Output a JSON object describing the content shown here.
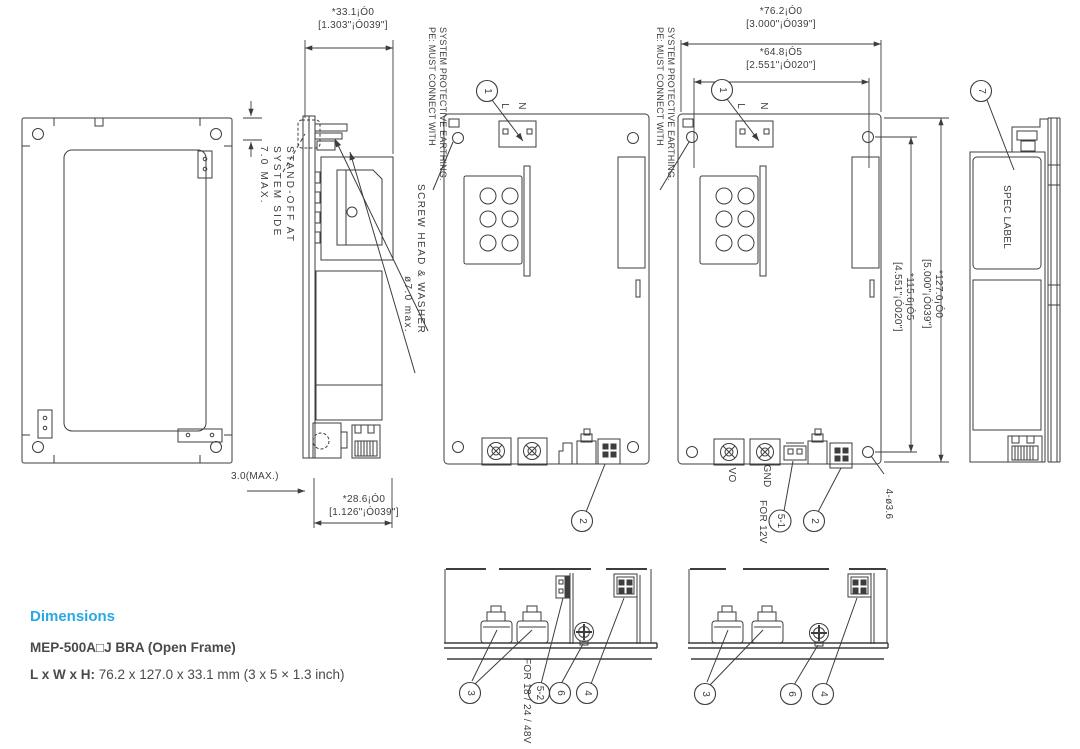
{
  "colors": {
    "accent": "#29a9e1",
    "line": "#3d3d3d",
    "text": "#4a4a4a"
  },
  "dims": {
    "w33_mm": "*33.1¡Ó0",
    "w33_in": "[1.303\"¡Ó039\"]",
    "w76_mm": "*76.2¡Ó0",
    "w76_in": "[3.000\"¡Ó039\"]",
    "w64_mm": "*64.8¡Ó5",
    "w64_in": "[2.551\"¡Ó020\"]",
    "h127_mm": "*127.0¡Ó0",
    "h127_in": "[5.000\"¡Ó039\"]",
    "h115_mm": "*115.6¡Ó5",
    "h115_in": "[4.551\"¡Ó020\"]",
    "w28_mm": "*28.6¡Ó0",
    "w28_in": "[1.126\"¡Ó039\"]",
    "t3_max": "3.0(MAX.)",
    "standoff_1": "STAND-OFF AT",
    "standoff_2": "SYSTEM SIDE",
    "standoff_3": "7.0 MAX.",
    "mounting_holes": "4-ø3.6"
  },
  "notes": {
    "pe_1": "PE: MUST CONNECT WITH",
    "pe_2": "SYSTEM PROTECTIVE EARTHING.",
    "screw_1": "SCREW HEAD & WASHER",
    "screw_2": "ø7.0 max.",
    "spec_label": "SPEC LABEL",
    "for_12v": "FOR 12V",
    "for_18_24_48v": "FOR 18 / 24 / 48V"
  },
  "labels": {
    "l": "L",
    "n": "N",
    "vo": "VO",
    "gnd": "GND"
  },
  "callouts": {
    "c1": "1",
    "c2": "2",
    "c3": "3",
    "c4": "4",
    "c5_1": "5-1",
    "c5_2": "5-2",
    "c6": "6",
    "c7": "7"
  },
  "footer": {
    "section_title": "Dimensions",
    "model_line": "MEP-500A□J BRA (Open Frame)",
    "lwh_label": "L x W x H:",
    "lwh_value": " 76.2 x 127.0 x 33.1 mm (3 x 5 × 1.3 inch)"
  }
}
